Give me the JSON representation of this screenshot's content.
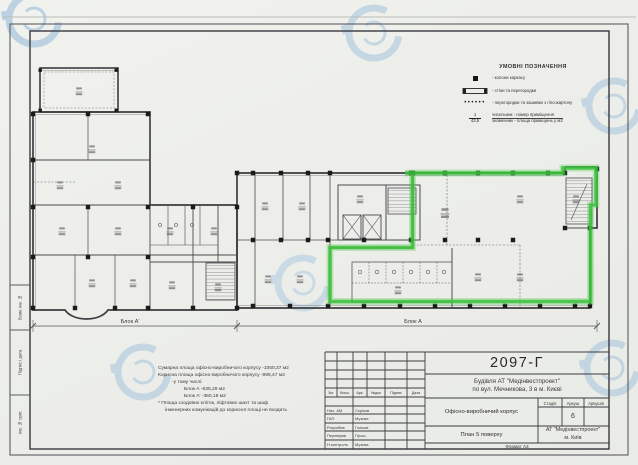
{
  "legend": {
    "title": "УМОВНІ ПОЗНАЧЕННЯ",
    "item_column": "- колони каркасу",
    "item_walls": "- стіни та перегородки",
    "item_partitions": "- перегородки та зашивки з гіпсокартону",
    "fraction_numerator": "1",
    "fraction_denominator": "43,5",
    "fraction_line1": "чисельник - номер приміщення",
    "fraction_line2": "знаменник - площа приміщень у м2"
  },
  "plan": {
    "block_a1_label": "Блок А'",
    "block_a_label": "Блок А"
  },
  "notes": {
    "lines": [
      "Сумарна площа офісно-виробничого корпусу   -1050,37 м2",
      "Корисна площа офісно-виробничого корпусу   -995,47 м2",
      "-у тому числі:",
      "Блок А   -635,29 м2",
      "Блок А'  -360,18 м2",
      "* Площа сходових кліток, ліфтових шахт та шаф",
      "інженерних комунікацій до корисної площі не входить"
    ]
  },
  "title_block": {
    "doc_number": "2097-Г",
    "project_line1": "Будівля АТ \"Медінвестпроект\"",
    "project_line2": "по вул. Мечникова, 3 в м. Києві",
    "object_name": "Офісно-виробничий корпус",
    "sheet_name": "План 5 поверху",
    "stage_header": "Стадія",
    "sheet_header": "Аркуш",
    "sheets_header": "Аркушів",
    "sheet_number": "6",
    "company_line1": "АТ \"Медінвестпроект\"",
    "company_line2": "м. Київ",
    "format_label": "Формат А3",
    "sig_headers": [
      "Зм.",
      "Кільк.",
      "Арк.",
      "№док",
      "Підпис",
      "Дата"
    ],
    "sig_rows": [
      {
        "role": "Нач. АМ",
        "name": "Сєріков"
      },
      {
        "role": "ГАП",
        "name": "Музика"
      },
      {
        "role": "Розробив",
        "name": "Голіков"
      },
      {
        "role": "Перевірив",
        "name": "Прош"
      },
      {
        "role": "Н.контроль",
        "name": "Музика"
      }
    ]
  },
  "side_strip": {
    "field_top": "Взам. інв. №",
    "field_middle": "Підпис і дата",
    "field_bottom": "Інв. № ориг."
  },
  "colors": {
    "highlight_green": "#3cc23c",
    "watermark_blue": "#9dc0dc",
    "line_dark": "#3b3b3b"
  }
}
